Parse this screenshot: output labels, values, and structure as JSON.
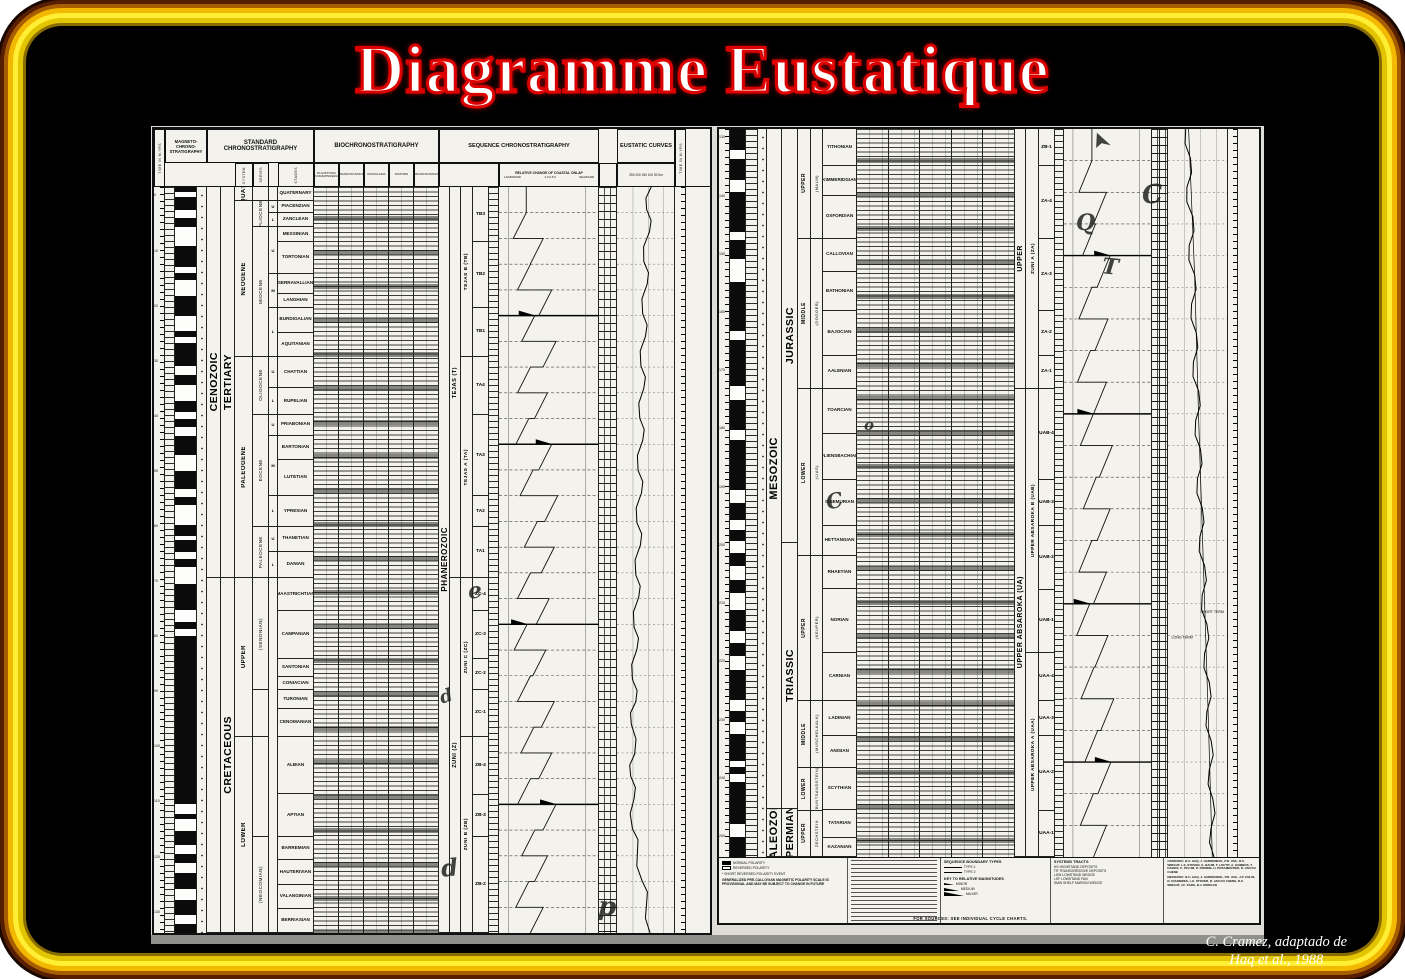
{
  "slide": {
    "title": "Diagramme Eustatique",
    "credit_line1": "C. Cramez, adaptado de",
    "credit_line2": "Haq et al., 1988",
    "colors": {
      "frame_gold": "#ffee33",
      "title_red": "#dd0000",
      "slide_bg": "#000000",
      "paper": "#f3f2ec"
    }
  },
  "headers": {
    "magneto": "MAGNETO-CHRONO-STRATIGRAPHY",
    "standard": "STANDARD CHRONOSTRATIGRAPHY",
    "bio": "BIOCHRONOSTRATIGRAPHY",
    "sequence": "SEQUENCE CHRONOSTRATIGRAPHY",
    "eustatic": "EUSTATIC CURVES",
    "onlap_title": "RELATIVE CHANGE OF COASTAL ONLAP",
    "landward": "LANDWARD",
    "seaward": "SEAWARD",
    "onlap_scale": "1.0        0.5        0",
    "eustatic_scale": "250 200 150 100 50 0m",
    "time": "TIME IN M.YRS",
    "sub_standard": [
      "SYSTEM",
      "SERIES",
      "STAGES"
    ],
    "bio_columns": [
      "PLANKTONIC FORAMINIFERA",
      "NANNOFOSSILS",
      "RADIOLARIA",
      "DIATOMS",
      "MACROFOSSILS"
    ]
  },
  "left_panel": {
    "time_numbers": [
      "0",
      "10",
      "20",
      "30",
      "40",
      "50",
      "60",
      "70",
      "80",
      "90",
      "100",
      "110",
      "120",
      "130"
    ],
    "magnetics": "1011010011101001100101110100110101100111010010110100111001011111111111111111111101001101011001101",
    "eras": [
      {
        "l": "CENOZOIC",
        "w": 15.55
      },
      {
        "l": "",
        "w": 14.1
      }
    ],
    "systems": [
      {
        "l": "TERTIARY",
        "w": 15.55
      },
      {
        "l": "CRETACEOUS",
        "w": 14.1
      }
    ],
    "series": [
      {
        "l": "QUAT.",
        "w": 0.55
      },
      {
        "l": "NEOGENE",
        "w": 6.2
      },
      {
        "l": "PALEOGENE",
        "w": 8.8
      },
      {
        "l": "UPPER",
        "w": 6.3
      },
      {
        "l": "LOWER",
        "w": 7.8
      }
    ],
    "epochs": [
      {
        "l": "",
        "w": 0.55
      },
      {
        "l": "PLIOCENE",
        "w": 1.05
      },
      {
        "l": "MIOCENE",
        "w": 5.15
      },
      {
        "l": "OLIGOCENE",
        "w": 2.3
      },
      {
        "l": "EOCENE",
        "w": 4.45
      },
      {
        "l": "PALEOCENE",
        "w": 2.05
      },
      {
        "l": "(SENONIAN)",
        "w": 4.45
      },
      {
        "l": "",
        "w": 1.85
      },
      {
        "l": "",
        "w": 4.0
      },
      {
        "l": "(NEOCOMIAN)",
        "w": 3.8
      }
    ],
    "subs": [
      {
        "l": "",
        "w": 0.55
      },
      {
        "l": "U",
        "w": 0.5
      },
      {
        "l": "L",
        "w": 0.55
      },
      {
        "l": "U",
        "w": 1.85
      },
      {
        "l": "M",
        "w": 1.35
      },
      {
        "l": "L",
        "w": 1.95
      },
      {
        "l": "U",
        "w": 1.25
      },
      {
        "l": "L",
        "w": 1.05
      },
      {
        "l": "U",
        "w": 0.85
      },
      {
        "l": "M",
        "w": 2.4
      },
      {
        "l": "L",
        "w": 1.2
      },
      {
        "l": "U",
        "w": 1.0
      },
      {
        "l": "L",
        "w": 1.05
      },
      {
        "l": "",
        "w": 14.1
      }
    ],
    "stages": [
      {
        "l": "QUATERNARY",
        "w": 0.55
      },
      {
        "l": "PIACENZIAN",
        "w": 0.5
      },
      {
        "l": "ZANCLEAN",
        "w": 0.55
      },
      {
        "l": "MESSINIAN",
        "w": 0.6
      },
      {
        "l": "TORTONIAN",
        "w": 1.25
      },
      {
        "l": "SERRAVALLIAN",
        "w": 0.8
      },
      {
        "l": "LANGHIAN",
        "w": 0.55
      },
      {
        "l": "BURDIGALIAN",
        "w": 1.0
      },
      {
        "l": "AQUITANIAN",
        "w": 0.95
      },
      {
        "l": "CHATTIAN",
        "w": 1.25
      },
      {
        "l": "RUPELIAN",
        "w": 1.05
      },
      {
        "l": "PRIABONIAN",
        "w": 0.85
      },
      {
        "l": "BARTONIAN",
        "w": 0.95
      },
      {
        "l": "LUTETIAN",
        "w": 1.45
      },
      {
        "l": "YPRESIAN",
        "w": 1.2
      },
      {
        "l": "THANETIAN",
        "w": 1.0
      },
      {
        "l": "DANIAN",
        "w": 1.05
      },
      {
        "l": "MAASTRICHTIAN",
        "w": 1.3
      },
      {
        "l": "CAMPANIAN",
        "w": 1.9
      },
      {
        "l": "SANTONIAN",
        "w": 0.75
      },
      {
        "l": "CONIACIAN",
        "w": 0.5
      },
      {
        "l": "TURONIAN",
        "w": 0.75
      },
      {
        "l": "CENOMANIAN",
        "w": 1.1
      },
      {
        "l": "ALBIAN",
        "w": 2.3
      },
      {
        "l": "APTIAN",
        "w": 1.7
      },
      {
        "l": "BARREMIAN",
        "w": 0.9
      },
      {
        "l": "HAUTERIVIAN",
        "w": 1.0
      },
      {
        "l": "VALANGINIAN",
        "w": 0.95
      },
      {
        "l": "BERRIASIAN",
        "w": 0.95
      }
    ],
    "mega1": [
      {
        "l": "PHANEROZOIC",
        "w": 29.65
      }
    ],
    "mega2": [
      {
        "l": "TEJAS (T)",
        "w": 15.55
      },
      {
        "l": "ZUNI (Z)",
        "w": 14.1
      }
    ],
    "mega3": [
      {
        "l": "TEJAS B (TB)",
        "w": 6.75
      },
      {
        "l": "TEJAS A (TA)",
        "w": 8.8
      },
      {
        "l": "ZUNI C (ZC)",
        "w": 6.3
      },
      {
        "l": "ZUNI B (ZB)",
        "w": 7.8
      }
    ],
    "sequences": [
      {
        "l": "TB3",
        "w": 2.2
      },
      {
        "l": "TB2",
        "w": 2.6
      },
      {
        "l": "TB1",
        "w": 1.95
      },
      {
        "l": "TA4",
        "w": 2.3
      },
      {
        "l": "TA3",
        "w": 3.25
      },
      {
        "l": "TA2",
        "w": 1.2
      },
      {
        "l": "TA1",
        "w": 2.05
      },
      {
        "l": "ZC-4",
        "w": 1.3
      },
      {
        "l": "ZC-3",
        "w": 1.9
      },
      {
        "l": "ZC-2",
        "w": 1.25
      },
      {
        "l": "ZC-1",
        "w": 1.85
      },
      {
        "l": "ZB-4",
        "w": 2.3
      },
      {
        "l": "ZB-3",
        "w": 1.7
      },
      {
        "l": "ZB-2",
        "w": 3.8
      }
    ],
    "onlap_x": [
      0.25,
      0.45,
      0.3,
      0.55,
      0.35,
      0.6,
      0.3,
      0.5,
      0.28,
      0.55,
      0.33,
      0.62,
      0.38,
      0.58,
      0.3,
      0.52,
      0.26,
      0.48,
      0.3,
      0.58,
      0.34,
      0.55,
      0.3,
      0.6,
      0.35,
      0.5,
      0.28,
      0.45
    ],
    "onlap_major": [
      4,
      9,
      16,
      23
    ],
    "eustatic_pts": [
      [
        0,
        0.6
      ],
      [
        0.03,
        0.52
      ],
      [
        0.06,
        0.57
      ],
      [
        0.1,
        0.47
      ],
      [
        0.13,
        0.53
      ],
      [
        0.17,
        0.45
      ],
      [
        0.2,
        0.5
      ],
      [
        0.24,
        0.42
      ],
      [
        0.27,
        0.47
      ],
      [
        0.31,
        0.4
      ],
      [
        0.34,
        0.45
      ],
      [
        0.38,
        0.37
      ],
      [
        0.41,
        0.43
      ],
      [
        0.45,
        0.35
      ],
      [
        0.48,
        0.41
      ],
      [
        0.52,
        0.33
      ],
      [
        0.55,
        0.38
      ],
      [
        0.59,
        0.3
      ],
      [
        0.62,
        0.35
      ],
      [
        0.66,
        0.27
      ],
      [
        0.69,
        0.33
      ],
      [
        0.72,
        0.25
      ],
      [
        0.76,
        0.31
      ],
      [
        0.79,
        0.24
      ],
      [
        0.82,
        0.3
      ],
      [
        0.86,
        0.27
      ],
      [
        0.89,
        0.36
      ],
      [
        0.93,
        0.44
      ],
      [
        0.96,
        0.52
      ],
      [
        1,
        0.58
      ]
    ]
  },
  "right_panel": {
    "time_numbers": [
      "130",
      "140",
      "150",
      "160",
      "170",
      "180",
      "190",
      "200",
      "210",
      "220",
      "230",
      "240",
      "250"
    ],
    "magnetics": "1110110111101100111110111101111011110011010101100110101111010110101111011",
    "eras": [
      {
        "l": "MESOZOIC",
        "w": 17.55
      },
      {
        "l": "PALEOZOIC",
        "w": 1.25
      }
    ],
    "systems": [
      {
        "l": "JURASSIC",
        "w": 10.7
      },
      {
        "l": "TRIASSIC",
        "w": 6.85
      },
      {
        "l": "PERMIAN",
        "w": 1.25
      }
    ],
    "series": [
      {
        "l": "UPPER",
        "w": 2.95
      },
      {
        "l": "MIDDLE",
        "w": 4.05
      },
      {
        "l": "LOWER",
        "w": 4.5
      },
      {
        "l": "UPPER",
        "w": 3.9
      },
      {
        "l": "MIDDLE",
        "w": 1.8
      },
      {
        "l": "LOWER",
        "w": 1.15
      },
      {
        "l": "UPPER",
        "w": 1.25
      }
    ],
    "subs": [
      {
        "l": "(MALM)",
        "w": 2.95
      },
      {
        "l": "(DOGGER)",
        "w": 4.05
      },
      {
        "l": "(LIAS)",
        "w": 4.5
      },
      {
        "l": "(KEUPER)",
        "w": 3.9
      },
      {
        "l": "(MUSCHELKALK)",
        "w": 1.8
      },
      {
        "l": "(BUNTSANDSTEIN)",
        "w": 1.15
      },
      {
        "l": "ZECHSTEIN",
        "w": 1.25
      }
    ],
    "stages": [
      {
        "l": "TITHONIAN",
        "w": 1.0
      },
      {
        "l": "KIMMERIDGIAN",
        "w": 0.8
      },
      {
        "l": "OXFORDIAN",
        "w": 1.15
      },
      {
        "l": "CALLOVIAN",
        "w": 0.9
      },
      {
        "l": "BATHONIAN",
        "w": 1.05
      },
      {
        "l": "BAJOCIAN",
        "w": 1.2
      },
      {
        "l": "AALENIAN",
        "w": 0.9
      },
      {
        "l": "TOARCIAN",
        "w": 1.2
      },
      {
        "l": "PLIENSBACHIAN",
        "w": 1.25
      },
      {
        "l": "SINEMURIAN",
        "w": 1.25
      },
      {
        "l": "HETTANGIAN",
        "w": 0.8
      },
      {
        "l": "RHAETIAN",
        "w": 0.9
      },
      {
        "l": "NORIAN",
        "w": 1.7
      },
      {
        "l": "CARNIAN",
        "w": 1.3
      },
      {
        "l": "LADINIAN",
        "w": 0.95
      },
      {
        "l": "ANISIAN",
        "w": 0.85
      },
      {
        "l": "SCYTHIAN",
        "w": 1.15
      },
      {
        "l": "TATARIAN",
        "w": 0.75
      },
      {
        "l": "KAZANIAN",
        "w": 0.5
      }
    ],
    "mega1": [
      {
        "l": "UPPER",
        "w": 7.0
      },
      {
        "l": "UPPER ABSAROKA (UA)",
        "w": 12.6
      }
    ],
    "mega2": [
      {
        "l": "ZUNI A (ZA)",
        "w": 7.0
      },
      {
        "l": "UPPER ABSAROKA B (UAB)",
        "w": 7.1
      },
      {
        "l": "UPPER ABSAROKA A (UAA)",
        "w": 5.5
      }
    ],
    "sequences": [
      {
        "l": "ZB-1",
        "w": 1.0
      },
      {
        "l": "ZA-4",
        "w": 1.95
      },
      {
        "l": "ZA-3",
        "w": 1.95
      },
      {
        "l": "ZA-2",
        "w": 1.2
      },
      {
        "l": "ZA-1",
        "w": 0.9
      },
      {
        "l": "UAB-4",
        "w": 2.45
      },
      {
        "l": "UAB-3",
        "w": 1.25
      },
      {
        "l": "UAB-2",
        "w": 1.7
      },
      {
        "l": "UAB-1",
        "w": 1.7
      },
      {
        "l": "UAA-4",
        "w": 1.3
      },
      {
        "l": "UAA-3",
        "w": 0.95
      },
      {
        "l": "UAA-2",
        "w": 2.0
      },
      {
        "l": "UAA-1",
        "w": 1.25
      }
    ],
    "onlap_x": [
      0.3,
      0.5,
      0.35,
      0.55,
      0.3,
      0.52,
      0.28,
      0.5,
      0.32,
      0.58,
      0.36,
      0.55,
      0.3,
      0.5,
      0.27,
      0.52,
      0.33,
      0.6,
      0.38,
      0.56,
      0.32,
      0.5
    ],
    "onlap_major": [
      3,
      8,
      14,
      19
    ],
    "eustatic_pts": [
      [
        0,
        0.3
      ],
      [
        0.04,
        0.38
      ],
      [
        0.08,
        0.32
      ],
      [
        0.12,
        0.42
      ],
      [
        0.16,
        0.36
      ],
      [
        0.2,
        0.45
      ],
      [
        0.24,
        0.4
      ],
      [
        0.28,
        0.48
      ],
      [
        0.32,
        0.43
      ],
      [
        0.36,
        0.52
      ],
      [
        0.4,
        0.47
      ],
      [
        0.44,
        0.55
      ],
      [
        0.48,
        0.5
      ],
      [
        0.52,
        0.58
      ],
      [
        0.56,
        0.54
      ],
      [
        0.6,
        0.62
      ],
      [
        0.64,
        0.58
      ],
      [
        0.68,
        0.66
      ],
      [
        0.72,
        0.62
      ],
      [
        0.76,
        0.7
      ],
      [
        0.8,
        0.66
      ],
      [
        0.84,
        0.73
      ],
      [
        0.88,
        0.7
      ],
      [
        0.92,
        0.76
      ],
      [
        0.96,
        0.73
      ],
      [
        1,
        0.78
      ]
    ],
    "eustatic_longterm": [
      [
        0,
        0.35
      ],
      [
        0.2,
        0.45
      ],
      [
        0.4,
        0.52
      ],
      [
        0.6,
        0.6
      ],
      [
        0.8,
        0.68
      ],
      [
        1,
        0.75
      ]
    ],
    "curve_label_long": "LONG TERM",
    "curve_label_short": "SHORT TERM"
  },
  "legend": {
    "polarity_normal": "NORMAL POLARITY",
    "polarity_reversed": "REVERSED POLARITY",
    "polarity_event": "* SHORT REVERSED POLARITY EVENT",
    "polarity_note": "GENERALIZED PRE-CALLOVIAN MAGNETIC POLARITY SCALE IS PROVISIONAL AND MAY BE SUBJECT TO CHANGE IN FUTURE",
    "boundary_title": "SEQUENCE BOUNDARY TYPES",
    "boundary_items": [
      "TYPE 1",
      "TYPE 2"
    ],
    "magnitude_title": "KEY TO RELATIVE MAGNITUDES",
    "magnitude_items": [
      "MINOR",
      "MEDIUM",
      "MAJOR"
    ],
    "tracts_title": "SYSTEMS TRACTS",
    "tracts_items": [
      "HS  HIGHSTAND DEPOSITS",
      "TR  TRANSGRESSIVE DEPOSITS",
      "LSW  LOWSTAND WEDGE",
      "LSF  LOWSTAND FAN",
      "SMW  SHELF MARGIN WEDGE"
    ],
    "credits_cenozoic": "CENOZOIC: B.U. HAQ, J. HARDENBOL, P.R. VAIL, R.C. WRIGHT, L.E. STOVER, G. BAUM, T. LOUTIT, A. GOMBOS, T. DAVIES, C. PFLUM, K. ROMINE, H. POSAMENTIER, R. JAN DU CHENE",
    "credits_mesozoic": "MESOZOIC: B.U. HAQ, J. HARDENBOL, P.R. VAIL, J.P. COLIN, R. IOANNIDES, L.E. STOVER, R. JAN DU CHENE, R.C. WRIGHT, J.F. SARG, B.J. MORGAN",
    "sources_line": "FOR SOURCES: SEE INDIVIDUAL CYCLE CHARTS."
  },
  "annotations": [
    {
      "glyph": "e",
      "x": 468,
      "y": 580,
      "size": 22,
      "rot": -8
    },
    {
      "glyph": "d",
      "x": 440,
      "y": 688,
      "size": 18,
      "rot": -18
    },
    {
      "glyph": "d",
      "x": 441,
      "y": 856,
      "size": 24,
      "rot": -5
    },
    {
      "glyph": "p",
      "x": 598,
      "y": 894,
      "size": 26,
      "rot": 4
    },
    {
      "glyph": "➤",
      "x": 1092,
      "y": 132,
      "size": 20,
      "rot": -115
    },
    {
      "glyph": "C",
      "x": 1142,
      "y": 182,
      "size": 26,
      "rot": -4
    },
    {
      "glyph": "Q",
      "x": 1076,
      "y": 212,
      "size": 22,
      "rot": 0
    },
    {
      "glyph": "T",
      "x": 1102,
      "y": 256,
      "size": 22,
      "rot": 6
    },
    {
      "glyph": "o",
      "x": 864,
      "y": 418,
      "size": 15,
      "rot": 0
    },
    {
      "glyph": "C",
      "x": 826,
      "y": 490,
      "size": 21,
      "rot": -12
    }
  ]
}
